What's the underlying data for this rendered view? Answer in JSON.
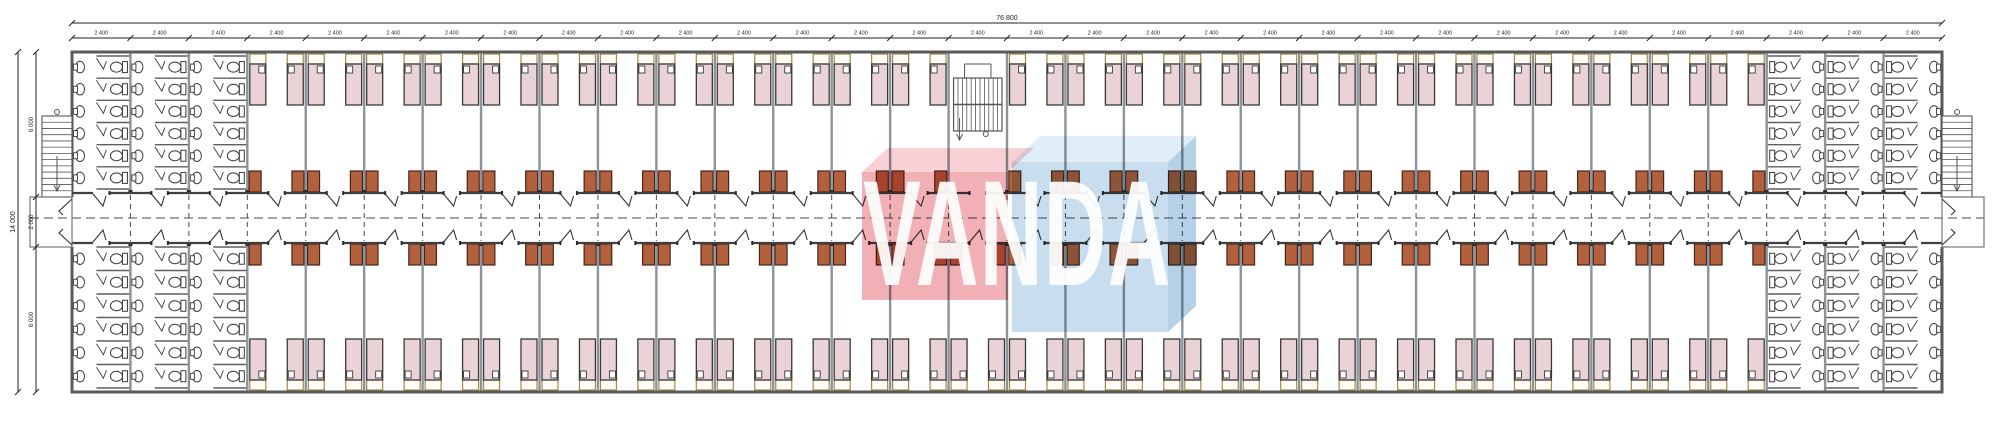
{
  "title": "dormitory-block-floor-plan",
  "watermark": {
    "text": "VANDA",
    "red_front": "#f0a7ae",
    "red_top": "#f7ccd0",
    "blue_front": "#c2dbee",
    "blue_top": "#ddecf6",
    "blue_side": "#aecbe2",
    "text_color": "#ffffff"
  },
  "dimensions": {
    "top_overall": "76 800",
    "top_segment": "2 400",
    "left_overall": "14 000",
    "left_top": "6 000",
    "left_mid": "2 000",
    "left_bottom": "6 000"
  },
  "layout": {
    "bays": 32,
    "top_row": {
      "wc_left": 3,
      "beds_before_stair": 12,
      "stair_bays": 1,
      "beds_after_stair": 13,
      "wc_right": 3
    },
    "bottom_row": {
      "wc_left": 3,
      "beds": 26,
      "wc_right": 3
    },
    "wc_stall_rows": 6,
    "beds_per_room": 2
  },
  "fixtures": {
    "bed": "bed",
    "headboard": "headboard-shelf",
    "pillow": "pillow",
    "wardrobe": "wardrobe",
    "toilet": "toilet",
    "sink": "wash-basin",
    "door": "door-swing",
    "stair_central": "central-staircase",
    "stair_left": "external-stair-left",
    "stair_right": "external-stair-right"
  },
  "colors": {
    "wall": "#5a5a5a",
    "party_wall": "#8a949c",
    "wall_cap": "#2b2b2b",
    "bed_fill": "#e9d3d7",
    "bed_stroke": "#3d3835",
    "headboard_stroke": "#a08a4e",
    "headboard_fill": "#fffdf6",
    "wardrobe_fill": "#b2613c",
    "wardrobe_stroke": "#46241a",
    "fixture": "#3a3a3a",
    "dash": "#4a4a4a",
    "dim": "#222222",
    "stair": "#555555"
  }
}
